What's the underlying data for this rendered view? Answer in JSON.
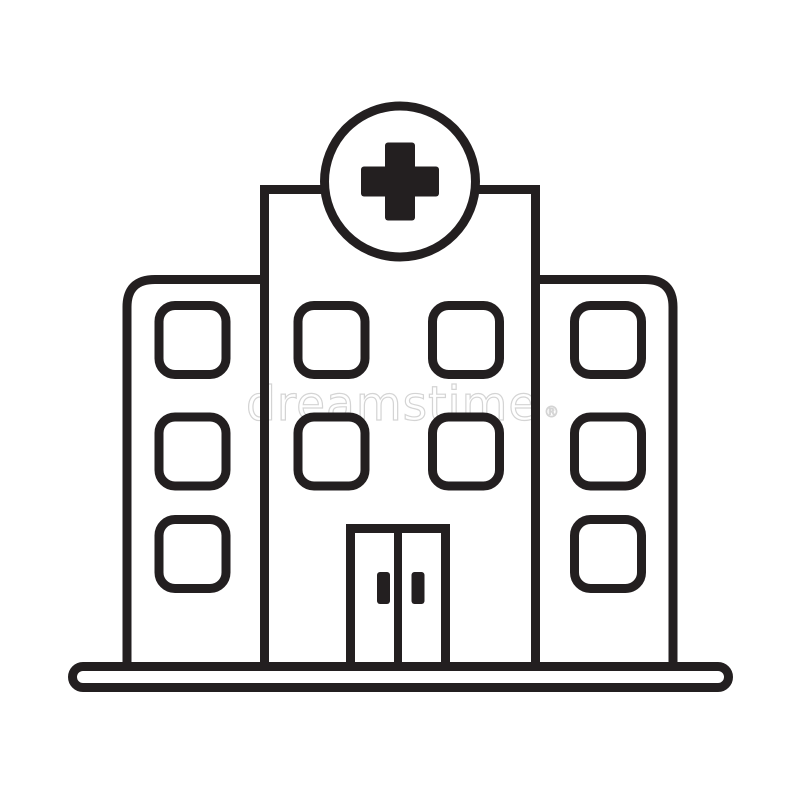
{
  "artwork": {
    "description": "Black and white outline icon of a hospital building with a medical cross in a circle on top, three window columns, a double entrance door and a ground base bar",
    "background_color": "#ffffff",
    "line_color": "#231f20"
  },
  "watermark": {
    "text": "dreamstime",
    "registered_mark": "®",
    "color": "#d4d4d4"
  }
}
